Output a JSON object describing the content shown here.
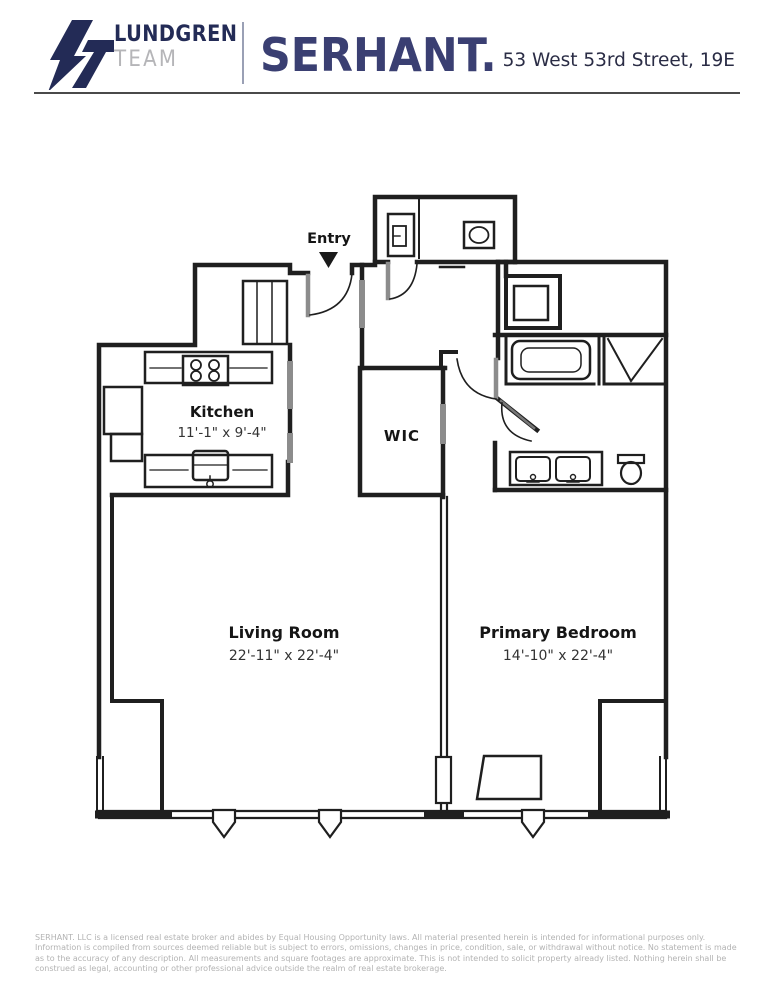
{
  "header": {
    "team_line1": "LUNDGREN",
    "team_line2": "TEAM",
    "brand": "SERHANT.",
    "address": "53 West 53rd Street, 19E"
  },
  "floorplan": {
    "entry": {
      "label": "Entry"
    },
    "kitchen": {
      "label": "Kitchen",
      "dims": "11'-1\" x 9'-4\""
    },
    "wic": {
      "label": "WIC"
    },
    "living_room": {
      "label": "Living Room",
      "dims": "22'-11\" x 22'-4\""
    },
    "primary_bedroom": {
      "label": "Primary Bedroom",
      "dims": "14'-10\" x 22'-4\""
    }
  },
  "footer": {
    "disclaimer": "SERHANT. LLC is a licensed real estate broker and abides by Equal Housing Opportunity laws. All material presented herein is intended for informational purposes only. Information is compiled from sources deemed reliable but is subject to errors, omissions, changes in price, condition, sale, or withdrawal without notice. No statement is made as to the accuracy of any description. All measurements and square footages are approximate. This is not intended to solicit property already listed. Nothing herein shall be construed as legal, accounting or other professional advice outside the realm of real estate brokerage."
  },
  "colors": {
    "brand_navy": "#232b56",
    "serhant_navy": "#3a3f72",
    "team_gray": "#b5b5b8",
    "wall_black": "#1f1f1f",
    "door_gray": "#8c8c8c",
    "disclaimer_gray": "#b3b3b3"
  }
}
